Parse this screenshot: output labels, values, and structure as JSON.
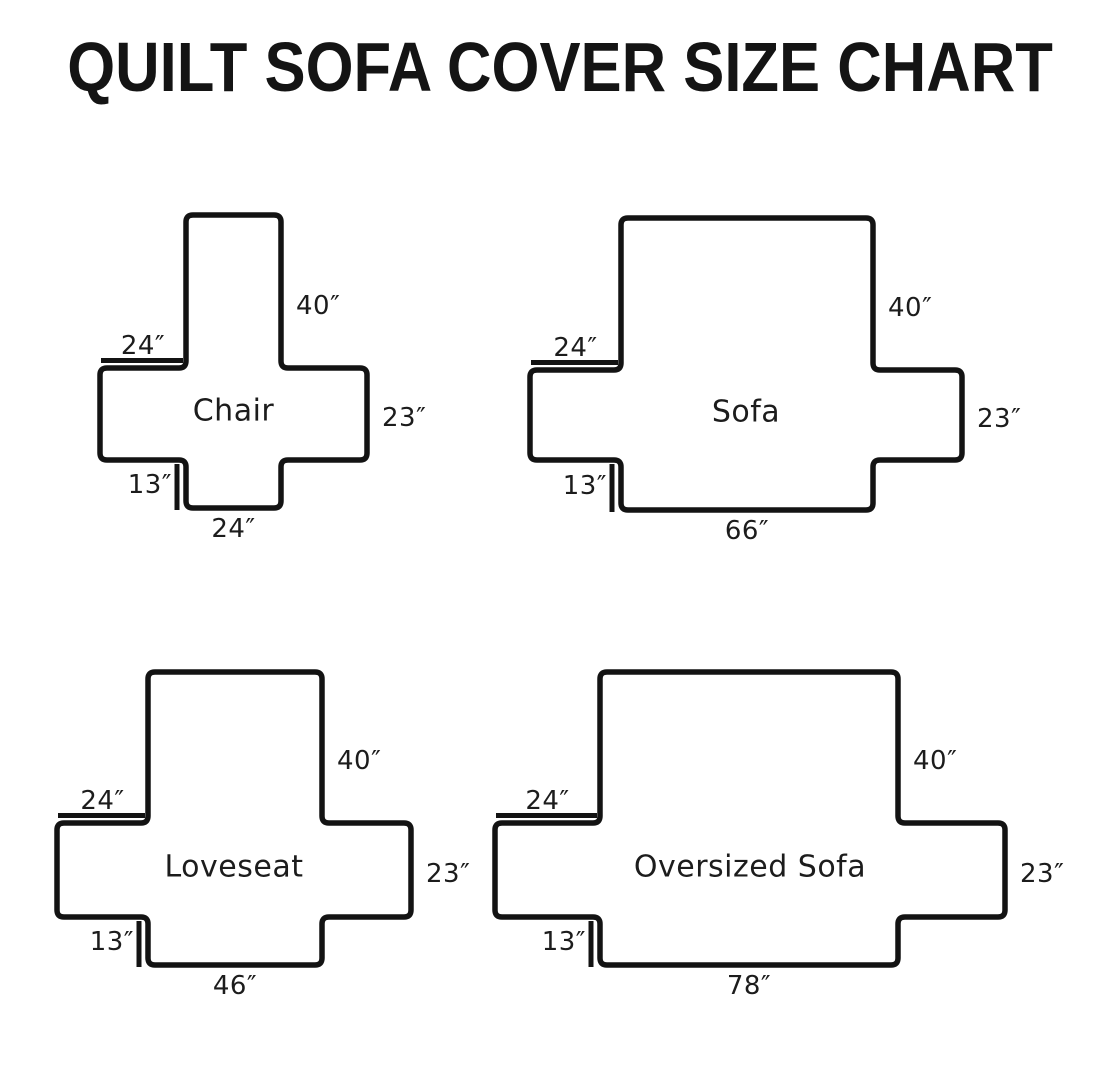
{
  "title": "QUILT SOFA COVER SIZE CHART",
  "unit": "inches",
  "diagrams": [
    {
      "id": "chair",
      "name": "Chair",
      "back_height": "40″",
      "arm_top_width": "24″",
      "side_height": "23″",
      "front_skirt_drop": "13″",
      "bottom_width": "24″",
      "dimensions_in": {
        "back_height": 40,
        "arm_top_width": 24,
        "side_height": 23,
        "front_skirt_drop": 13,
        "bottom_width": 24
      }
    },
    {
      "id": "sofa",
      "name": "Sofa",
      "back_height": "40″",
      "arm_top_width": "24″",
      "side_height": "23″",
      "front_skirt_drop": "13″",
      "bottom_width": "66″",
      "dimensions_in": {
        "back_height": 40,
        "arm_top_width": 24,
        "side_height": 23,
        "front_skirt_drop": 13,
        "bottom_width": 66
      }
    },
    {
      "id": "loveseat",
      "name": "Loveseat",
      "back_height": "40″",
      "arm_top_width": "24″",
      "side_height": "23″",
      "front_skirt_drop": "13″",
      "bottom_width": "46″",
      "dimensions_in": {
        "back_height": 40,
        "arm_top_width": 24,
        "side_height": 23,
        "front_skirt_drop": 13,
        "bottom_width": 46
      }
    },
    {
      "id": "oversized-sofa",
      "name": "Oversized Sofa",
      "back_height": "40″",
      "arm_top_width": "24″",
      "side_height": "23″",
      "front_skirt_drop": "13″",
      "bottom_width": "78″",
      "dimensions_in": {
        "back_height": 40,
        "arm_top_width": 24,
        "side_height": 23,
        "front_skirt_drop": 13,
        "bottom_width": 78
      }
    }
  ],
  "colors": {
    "ink": "#131313",
    "background": "#ffffff"
  }
}
